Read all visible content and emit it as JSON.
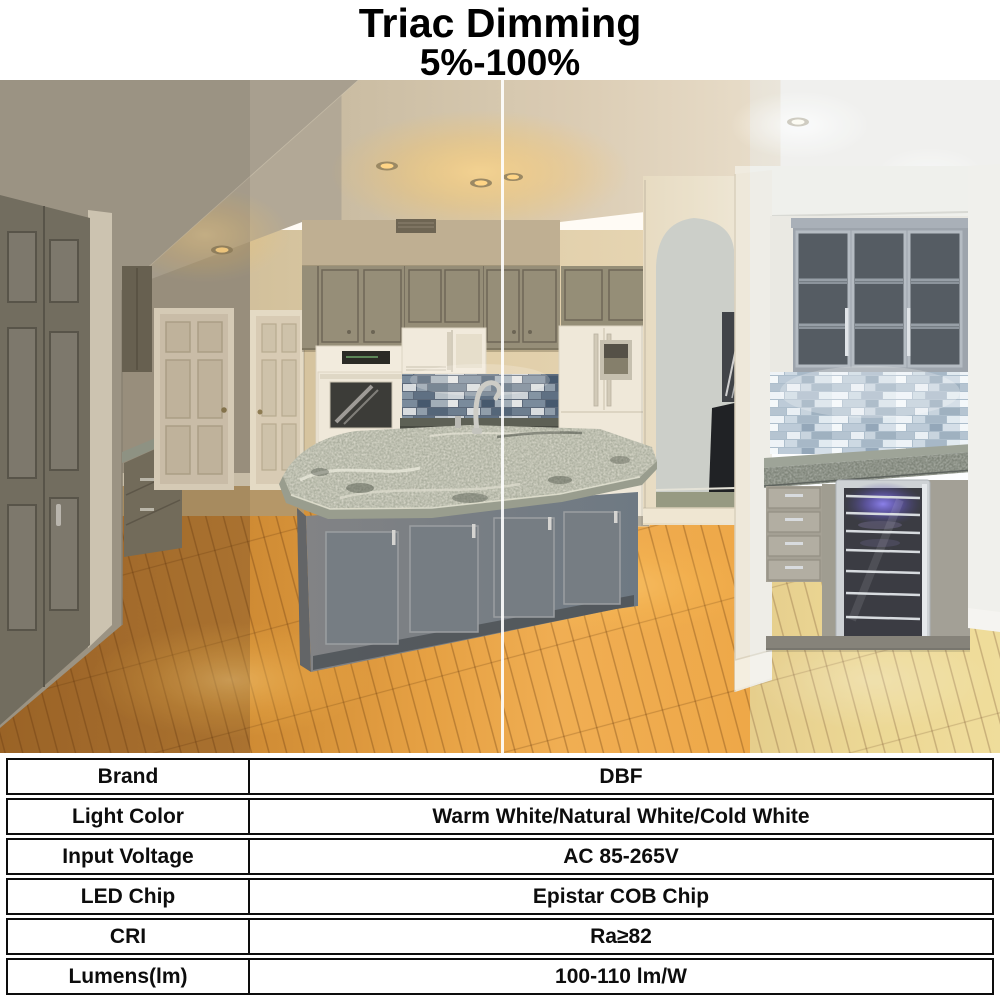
{
  "header": {
    "title": "Triac Dimming",
    "subtitle": "5%-100%"
  },
  "photo": {
    "description": "Kitchen interior photographed under three LED color temperature zones, split by vertical dividers",
    "zones": [
      {
        "name": "warm-white-zone"
      },
      {
        "name": "natural-white-zone"
      },
      {
        "name": "cold-white-zone"
      }
    ]
  },
  "colors": {
    "tint_warm": "#7a5c32",
    "tint_natural": "#ffb84d",
    "tint_cold": "#eef3f8"
  },
  "spec_table": {
    "rows": [
      {
        "label": "Brand",
        "value": "DBF"
      },
      {
        "label": "Light Color",
        "value": "Warm White/Natural White/Cold White"
      },
      {
        "label": "Input Voltage",
        "value": "AC 85-265V"
      },
      {
        "label": "LED Chip",
        "value": "Epistar COB Chip"
      },
      {
        "label": "CRI",
        "value": "Ra≥82"
      },
      {
        "label": "Lumens(lm)",
        "value": "100-110 lm/W"
      }
    ]
  }
}
